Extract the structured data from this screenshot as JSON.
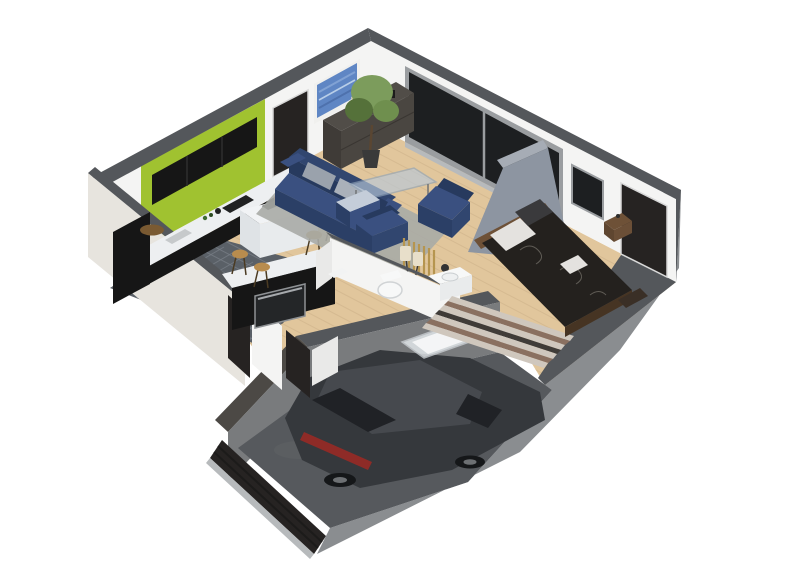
{
  "scene": {
    "description": "Isometric 3D cutaway floor plan render of a single-storey house with open living room, kitchen, bedroom, bathroom, hallway and an attached sunken garage containing a dark grey hatchback car",
    "background": "#ffffff",
    "rooms": [
      {
        "name": "living-room",
        "floor": "light-oak-wood"
      },
      {
        "name": "kitchen",
        "floor": "slate-tile",
        "accent_wall": "#a0c230"
      },
      {
        "name": "bedroom",
        "floor": "light-oak-wood"
      },
      {
        "name": "bathroom",
        "floor": "light"
      },
      {
        "name": "hallway",
        "floor": "light-oak-wood"
      },
      {
        "name": "garage",
        "floor": "concrete"
      }
    ],
    "furniture": [
      "navy-three-seat-sofa",
      "navy-armchair",
      "navy-lounge-chair",
      "blue-ottoman",
      "glass-coffee-table",
      "grey-area-rug",
      "dark-wood-sideboard",
      "blue-abstract-wall-art",
      "potted-tree",
      "floor-lamp",
      "kitchen-counter",
      "black-upper-cabinets",
      "white-kitchen-island",
      "wooden-bar-stools",
      "oven-counter",
      "double-bed",
      "striped-rug",
      "nightstand",
      "corner-toilet",
      "sink-vanity",
      "glass-shower",
      "entry-doors",
      "sliding-glass-window",
      "garage-door"
    ],
    "vehicle": {
      "type": "hatchback-car",
      "color": "#35383c"
    },
    "palette": {
      "bg": "#ffffff",
      "band": "#54575b",
      "bandLight": "#a6acb5",
      "wallWhite": "#f4f4f3",
      "wallShade": "#e9e9e8",
      "extCream": "#e7e4de",
      "extGray": "#8a8d90",
      "green": "#a0c230",
      "cabinetBlack": "#161616",
      "counterWhite": "#edeff1",
      "tile": "#5a6067",
      "wood": "#e1c69c",
      "garageTop": "#4c4945",
      "stone": "#797b7d",
      "garageFloor": "#56595d",
      "mottle": "#63666a",
      "doorDark": "#262322",
      "windowGlass": "#1d1f21",
      "frameGray": "#9a9da0",
      "sill": "#b7babc",
      "navy": "#31466f",
      "navyDark": "#273a5e",
      "navySeat": "#3a5080",
      "navyFace": "#2b3f66",
      "cushionGray": "#9aa2ac",
      "cushionGray2": "#aab1ba",
      "poufTop": "#c4cdd9",
      "rugGray": "#a9aba6",
      "glass": "#b9c9da",
      "sideboard": "#4a4641",
      "sideboardTop": "#514d48",
      "sideboardSide": "#3f3b37",
      "plantGreen": "#6f8f4e",
      "plantDark": "#55713a",
      "plantLight": "#7c9c5c",
      "pot": "#3a3a3a",
      "trunk": "#5a4632",
      "artBlue": "#5f86c4",
      "artLight": "#8aa9d8",
      "duvet": "#24211e",
      "headboard": "#6e5137",
      "bedBase": "#463423",
      "pillowWhite": "#e4e2df",
      "pillowDark": "#3a3a3c",
      "stripeLight": "#cfc7bd",
      "stripeBrown": "#8a7060",
      "stripeDark": "#403c38",
      "stoolWood": "#b88c4e",
      "bathWhite": "#f7f8f8",
      "bathShade": "#e9ebec",
      "glassPanel": "#e8edf0",
      "carBody": "#35383c",
      "carRoof": "#46494e",
      "carGlass": "#202226",
      "taillight": "#8e2b27",
      "rim": "#6d7073",
      "lampCream": "#e8dfca",
      "red": "#c23a2e",
      "woodMat": "#7a5a32",
      "cooktop": "#202122",
      "sinkSteel": "#c6c9cb"
    }
  }
}
